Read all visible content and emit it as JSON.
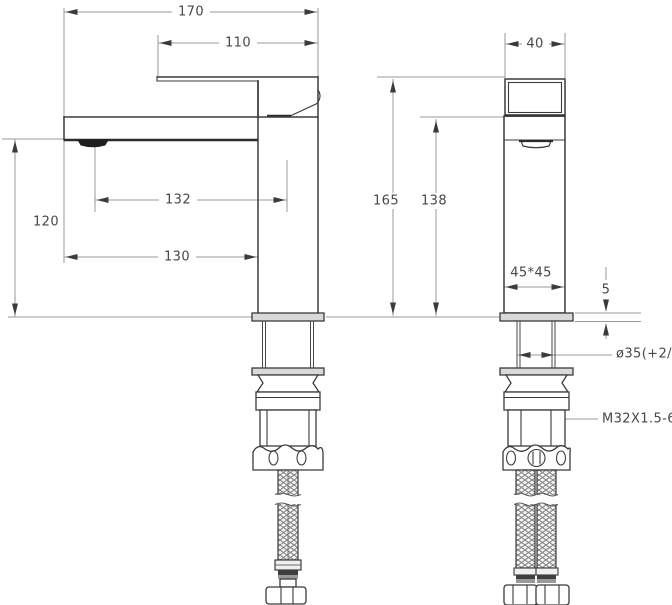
{
  "drawing": {
    "kind": "single-lever basin faucet installation drawing",
    "views": {
      "left": "side-view",
      "right": "front-view"
    },
    "colors": {
      "outline": "#3b3b3b",
      "dimension_lines": "#9a9a9a",
      "text": "#474747",
      "metal_fill": "#d9d9d9",
      "background": "#ffffff"
    }
  },
  "side_view": {
    "dims": {
      "overall_length": "170",
      "handle_length": "110",
      "spout_height": "120",
      "aerator_offset": "132",
      "spout_reach": "130"
    }
  },
  "front_view": {
    "dims": {
      "handle_width": "40",
      "overall_height": "165",
      "body_height": "138",
      "body_section": "45*45",
      "deck_plate_thickness": "5",
      "mounting_hole": "ø35(+2/-1)",
      "thread": "M32X1.5-6g"
    }
  }
}
